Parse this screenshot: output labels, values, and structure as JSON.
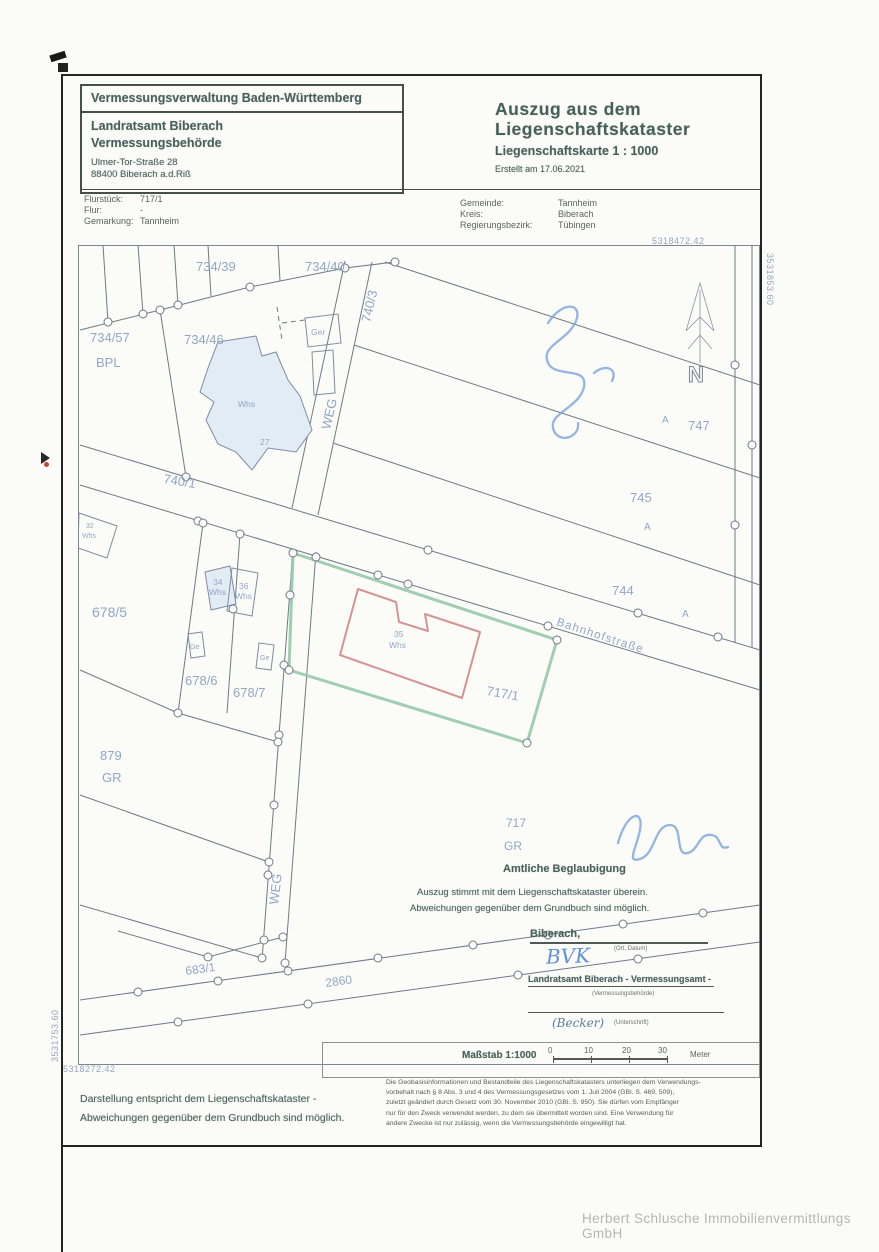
{
  "header": {
    "authority": "Vermessungsverwaltung Baden-Württemberg",
    "office_line1": "Landratsamt Biberach",
    "office_line2": "Vermessungsbehörde",
    "address_line1": "Ulmer-Tor-Straße 28",
    "address_line2": "88400 Biberach a.d.Riß",
    "title_line1": "Auszug aus dem",
    "title_line2": "Liegenschaftskataster",
    "subtitle": "Liegenschaftskarte 1 : 1000",
    "created": "Erstellt am 17.06.2021"
  },
  "parcel_info": {
    "flurstueck_label": "Flurstück:",
    "flurstueck_value": "717/1",
    "flur_label": "Flur:",
    "flur_value": "-",
    "gemarkung_label": "Gemarkung:",
    "gemarkung_value": "Tannheim",
    "gemeinde_label": "Gemeinde:",
    "gemeinde_value": "Tannheim",
    "kreis_label": "Kreis:",
    "kreis_value": "Biberach",
    "regbez_label": "Regierungsbezirk:",
    "regbez_value": "Tübingen"
  },
  "map": {
    "coord_top": "5318472.42",
    "coord_right": "3531853.60",
    "coord_bottom": "5318272.42",
    "coord_left": "3531753.60",
    "north_label": "N",
    "labels": {
      "p734_39": "734/39",
      "p734_40": "734/40",
      "p734_57": "734/57",
      "bpl": "BPL",
      "p734_46": "734/46",
      "ger": "Ger",
      "p740_3": "740/3",
      "weg_top": "WEG",
      "whs27": "Whs",
      "no27": "27",
      "p740_1": "740/1",
      "whs32_no": "32",
      "whs32": "Whs",
      "p678_5": "678/5",
      "p678_6": "678/6",
      "p678_7": "678/7",
      "whs34_no": "34",
      "whs34": "Whs",
      "whs36_no": "36",
      "whs36": "Whs",
      "ge1": "Ge",
      "ge2": "Ge",
      "p879": "879",
      "gr879": "GR",
      "weg_bottom": "WEG",
      "whs35_no": "35",
      "whs35": "Whs",
      "p717_1": "717/1",
      "bahnhofstrasse": "Bahnhofstraße",
      "p744": "744",
      "p745": "745",
      "p747": "747",
      "a1": "A",
      "a2": "A",
      "a3": "A",
      "p717": "717",
      "gr717": "GR",
      "p683_1": "683/1",
      "p2860": "2860"
    }
  },
  "certification": {
    "heading": "Amtliche Beglaubigung",
    "line1": "Auszug stimmt mit dem Liegenschaftskataster überein.",
    "line2": "Abweichungen gegenüber dem Grundbuch sind möglich.",
    "place": "Biberach,",
    "place_hint": "(Ort, Datum)",
    "stamp_initials": "BVK",
    "office": "Landratsamt Biberach - Vermessungsamt -",
    "office_hint": "(Vermessungsbehörde)",
    "signature_name": "(Becker)",
    "signature_hint": "(Unterschrift)"
  },
  "scale": {
    "label": "Maßstab 1:1000",
    "ticks": [
      "0",
      "10",
      "20",
      "30"
    ],
    "unit": "Meter"
  },
  "notes": {
    "left_line1": "Darstellung entspricht dem Liegenschaftskataster -",
    "left_line2": "Abweichungen gegenüber dem Grundbuch sind möglich.",
    "legal_lines": [
      "Die Geobasisinformationen und Bestandteile des Liegenschaftskatasters unterliegen dem Verwendungs-",
      "vorbehalt nach § 8 Abs. 3 und 4 des Vermessungsgesetzes vom 1. Juli 2004 (GBl. S. 469, 509),",
      "zuletzt geändert durch Gesetz vom 30. November 2010 (GBl. S. 950). Sie dürfen vom Empfänger",
      "nur für den Zweck verwendet werden, zu dem sie übermittelt worden sind. Eine Verwendung für",
      "andere Zwecke ist nur zulässig, wenn die Vermessungsbehörde eingewilligt hat."
    ]
  },
  "watermark": "Herbert Schlusche Immobilienvermittlungs GmbH",
  "colors": {
    "stamp": "#46605b",
    "map_line": "#6e7a88",
    "map_label": "#91a7c7",
    "parcel_highlight": "#8fc6a4",
    "building_highlight": "#d49494",
    "pen_blue": "#5e93d6"
  }
}
